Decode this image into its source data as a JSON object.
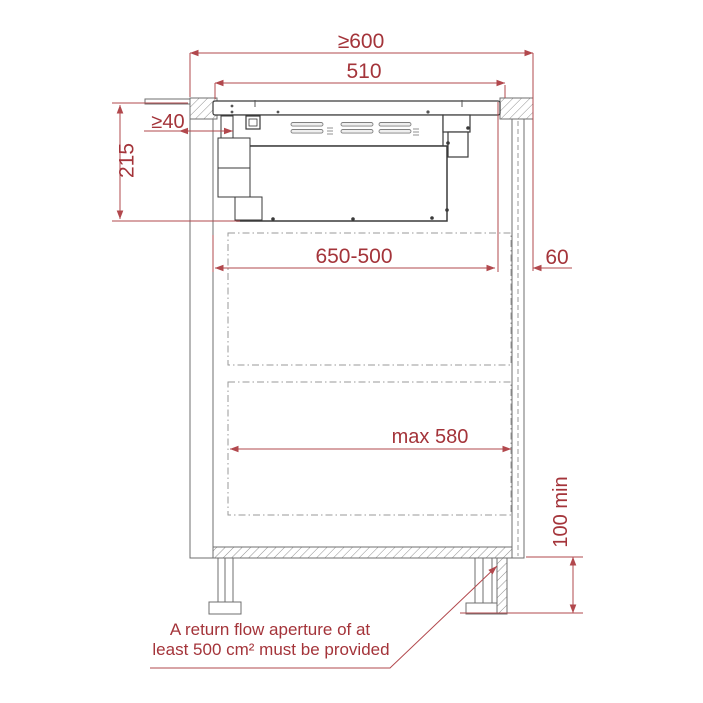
{
  "diagram": {
    "title_hint": "hob-and-extractor-cabinet-installation-cross-section",
    "dimensions": {
      "worktop_min_width": "≥600",
      "hob_width": "510",
      "duct_min_gap": "≥40",
      "depth_below_worktop": "215",
      "adjustable_internal_depth": "650-500",
      "rear_clearance": "60",
      "drawer_max_width": "max 580",
      "plinth_min_height": "100 min"
    },
    "note": {
      "line1": "A return flow aperture of at",
      "line2": "least 500 cm² must be provided"
    },
    "colors": {
      "dimension_text": "#a4343a",
      "dimension_line": "#b2484d",
      "structure_line": "#6f6f6f",
      "appliance_line": "#3a3a3a",
      "background": "#ffffff"
    }
  }
}
